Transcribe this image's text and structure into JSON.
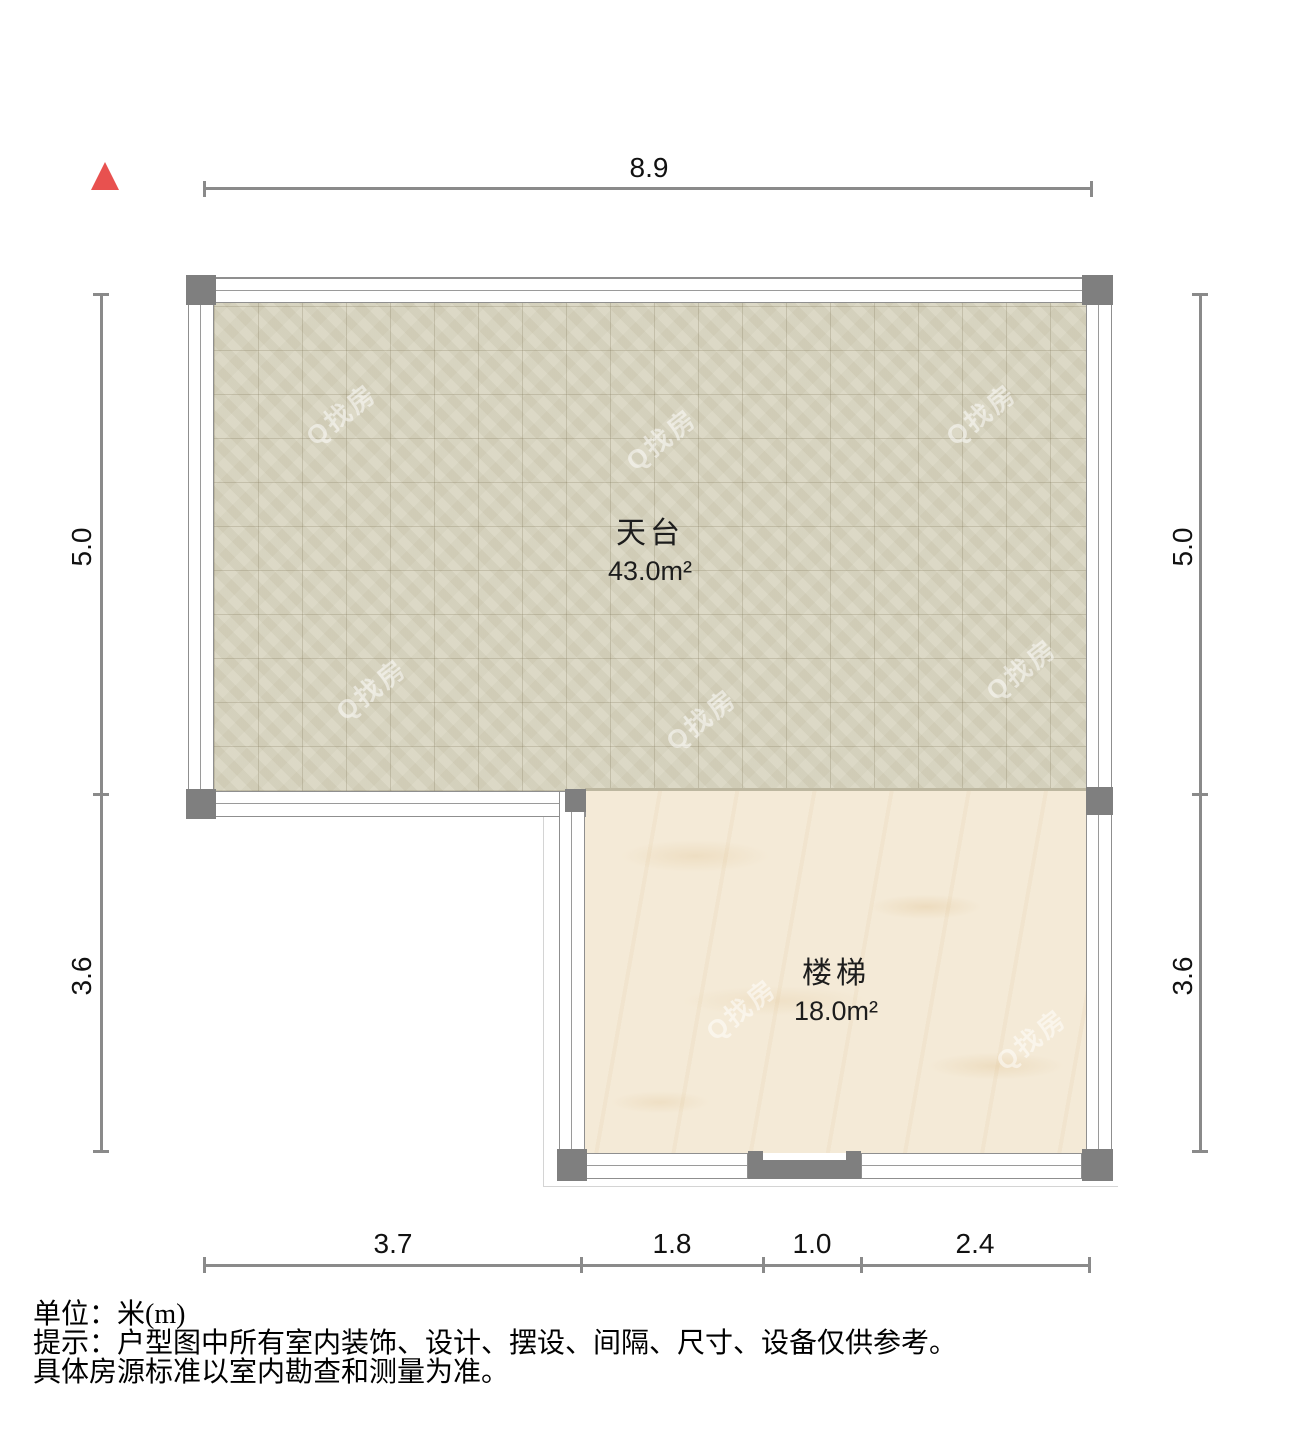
{
  "plan": {
    "rooms": [
      {
        "name": "天台",
        "area": "43.0m²"
      },
      {
        "name": "楼梯",
        "area": "18.0m²"
      }
    ],
    "dimensions": {
      "top": "8.9",
      "bottom": [
        "3.7",
        "1.8",
        "1.0",
        "2.4"
      ],
      "left": [
        "5.0",
        "3.6"
      ],
      "right": [
        "5.0",
        "3.6"
      ]
    }
  },
  "watermark": "Q找房",
  "notes": {
    "unit": "单位：米(m)",
    "tip_line1": "提示：户型图中所有室内装饰、设计、摆设、间隔、尺寸、设备仅供参考。",
    "tip_line2": "具体房源标准以室内勘查和测量为准。"
  },
  "colors": {
    "north_arrow": "#e8514f",
    "dimension_line": "#8a8a8a",
    "wall_line": "#8f8f8f",
    "pillar": "#7f7f7f",
    "terrace_floor": "#d9d5c1",
    "stairs_floor": "#f4ead7"
  }
}
